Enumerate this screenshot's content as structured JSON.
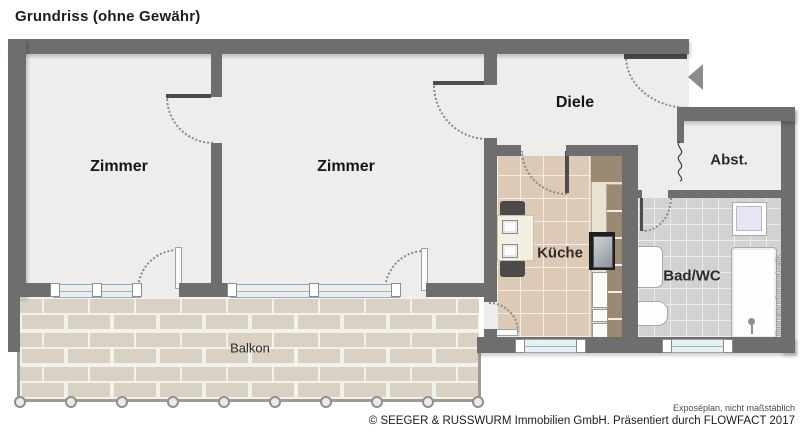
{
  "title": "Grundriss (ohne Gewähr)",
  "rooms": {
    "zimmer_left": "Zimmer",
    "zimmer_mid": "Zimmer",
    "diele": "Diele",
    "abst": "Abst.",
    "kueche": "Küche",
    "bad": "Bad/WC",
    "balkon": "Balkon"
  },
  "footer": {
    "note": "Exposéplan, nicht maßstäblich",
    "copyright": "© SEEGER & RUSSWURM Immobilien GmbH. Präsentiert durch FLOWFACT 2017"
  },
  "watermark": "Illustration©ImmoGrafik",
  "icons": {
    "entrance_arrow": "entrance-arrow-icon"
  },
  "colors": {
    "wall": "#6e6e6e",
    "floor": "#eeedeb",
    "kitchen_tile": "#dccab7",
    "bath_tile": "#d2d2d2",
    "balcony_brick": "#d8d1c4",
    "window_glass": "#e7eff3",
    "counter_brown": "#9a8a73"
  }
}
